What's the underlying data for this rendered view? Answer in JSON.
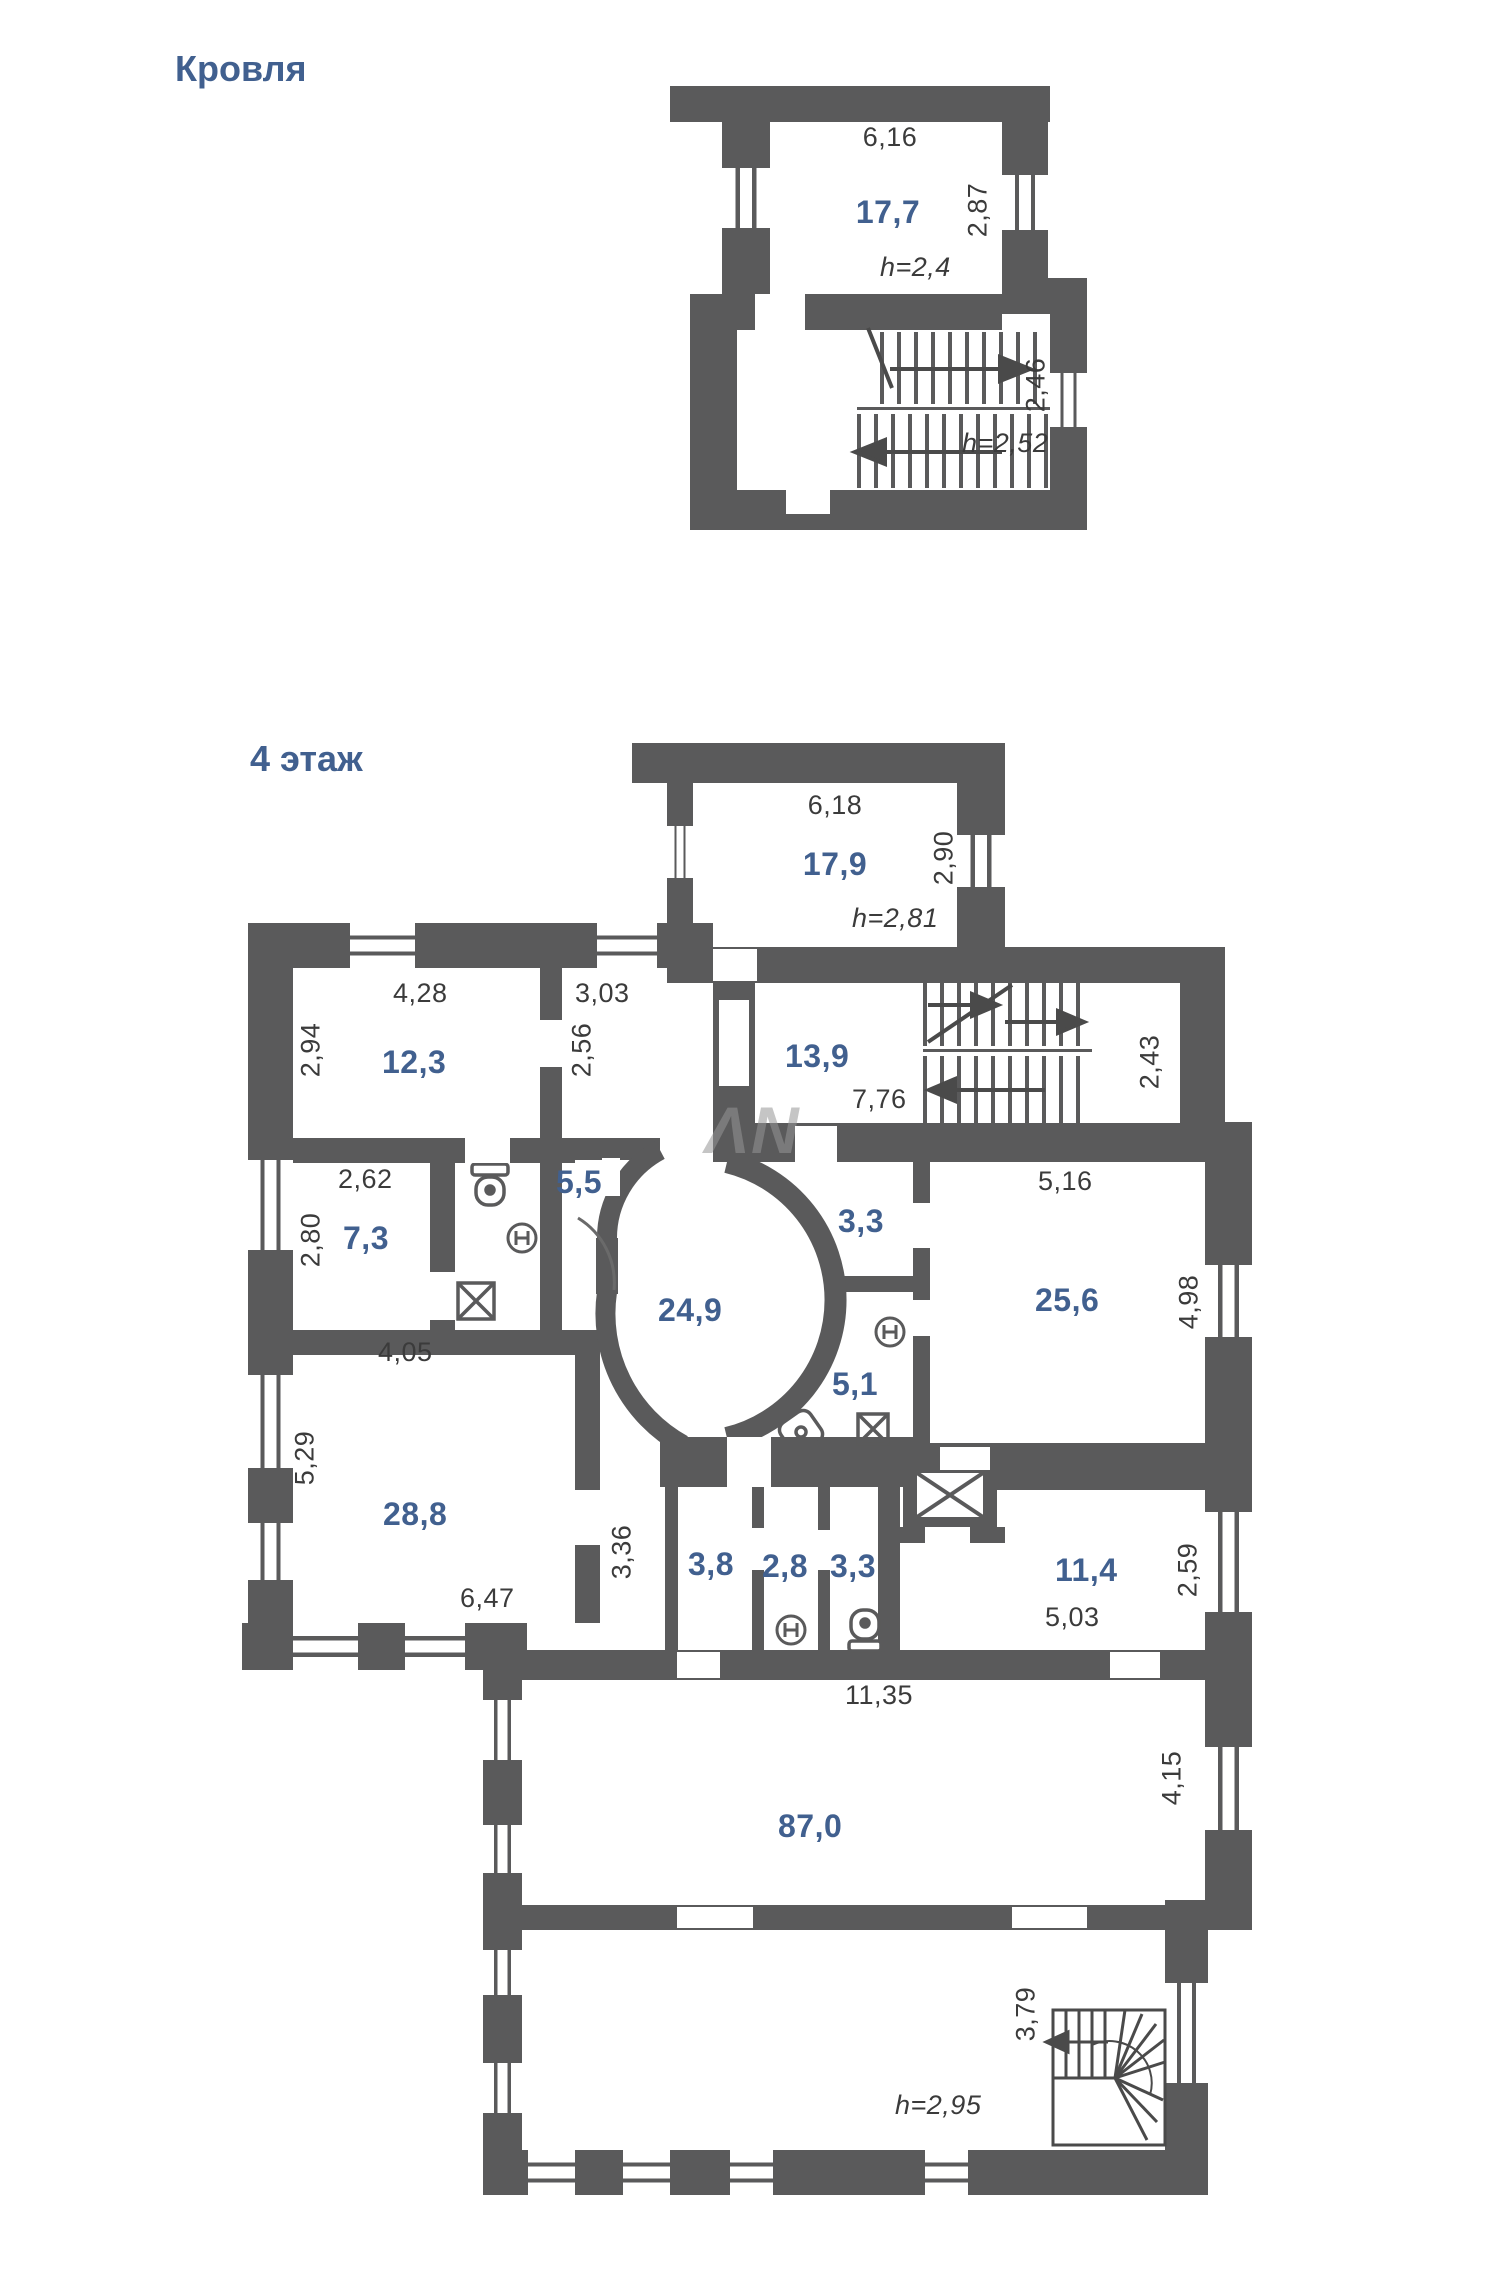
{
  "colors": {
    "wall": "#5a5a5b",
    "area_label": "#41608f",
    "dimension_text": "#3b3b3b",
    "background": "#ffffff"
  },
  "watermark": "ΛN",
  "roof": {
    "title": "Кровля",
    "labels": {
      "width_top": "6,16",
      "area_attic": "17,7",
      "dim_right_attic": "2,87",
      "ceiling_attic": "h=2,4",
      "dim_right_stair": "2,46",
      "ceiling_stair": "h=2,52"
    }
  },
  "floor4": {
    "title": "4 этаж",
    "labels": {
      "attic_width": "6,18",
      "attic_area": "17,9",
      "attic_dim_right": "2,90",
      "attic_ceiling": "h=2,81",
      "r123_width": "4,28",
      "r123_height": "2,94",
      "r123_area": "12,3",
      "hall_width": "3,03",
      "hall_height": "2,56",
      "r139_area": "13,9",
      "stair_width": "7,76",
      "stair_dim_right": "2,43",
      "r73_width": "2,62",
      "r73_height": "2,80",
      "r73_area": "7,3",
      "r73_bottom": "4,05",
      "r55_area": "5,5",
      "r249_area": "24,9",
      "r33a_area": "3,3",
      "r51_area": "5,1",
      "r256_width": "5,16",
      "r256_area": "25,6",
      "r256_height": "4,98",
      "r288_height": "5,29",
      "r288_area": "28,8",
      "r288_width": "6,47",
      "hall2_height": "3,36",
      "r38_area": "3,8",
      "r28_area": "2,8",
      "r33b_area": "3,3",
      "r114_area": "11,4",
      "r114_width": "5,03",
      "r114_height": "2,59",
      "r870_width": "11,35",
      "r870_area": "87,0",
      "r870_height": "4,15",
      "bottom_height": "3,79",
      "bottom_ceiling": "h=2,95"
    }
  },
  "icons": {
    "toilet": "toilet-icon",
    "sink": "sink-icon",
    "shower": "shower-icon",
    "washing_machine": "washing-machine-icon",
    "elevator": "elevator-icon",
    "stairs_up_arrow": "arrow-right-icon",
    "stairs_down_arrow": "arrow-left-icon"
  }
}
